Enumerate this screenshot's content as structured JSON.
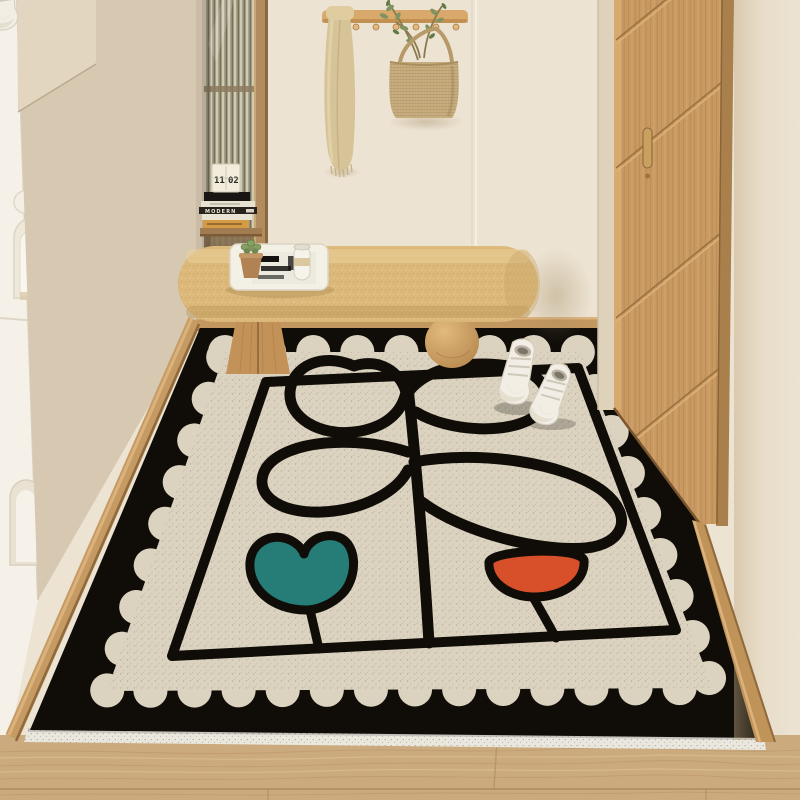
{
  "scene": {
    "description": "Entryway interior photo: cream walls, oak door, fluted-glass niche with books, wood coat rack with towel and woven bag, boucle bench with tray, white high-top sneakers on a black scallop-edge doormat printed with a line-art plant and teal and orange tulip flowers, wood plank floor"
  },
  "decor": {
    "calendar_left_digits": "11",
    "calendar_right_digits": "02",
    "book_spine_title": "MODERN"
  },
  "palette": {
    "wall": "#ece3d2",
    "white_cabinet": "#f5f1e8",
    "beige_cabinet": "#d7c8b1",
    "rack_wood": "#d9a96b",
    "towel": "#d6c498",
    "basket": "#c8ae7e",
    "leaf_green": "#7d9460",
    "door_wood": "#c89a62",
    "bench_cushion": "#dcb87a",
    "bench_leg": "#c39258",
    "floor_wood": "#cbab7e",
    "mat_black": "#100d09",
    "mat_cream": "#dbd3bf",
    "flower_teal": "#267c76",
    "flower_orange": "#d8502a",
    "book_orange": "#d49a44"
  }
}
